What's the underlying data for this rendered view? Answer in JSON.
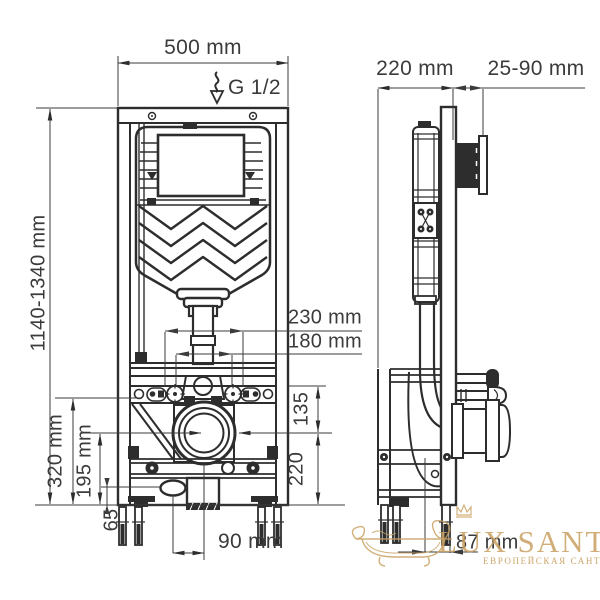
{
  "title": "Concealed WC installation frame — dimensional drawing",
  "views": {
    "front": {
      "width": "500 mm",
      "height": "1140-1340 mm",
      "water_supply": "G 1/2",
      "fixing_outer": "230 mm",
      "fixing_inner": "180 mm",
      "stud_to_outlet": "135",
      "outlet_to_floor": "220",
      "bracket_height": "320 mm",
      "outlet_height": "195 mm",
      "inlet_height": "65",
      "inlet_offset": "90 mm"
    },
    "side": {
      "depth": "220 mm",
      "wall_distance": "25-90 mm",
      "outlet_offset": "87 mm"
    }
  },
  "watermark": {
    "brand": "LUX SANTEH",
    "tagline": "ЕВРОПЕЙСКАЯ САНТЕХНИКА",
    "color": "#c9a262"
  },
  "colors": {
    "line": "#2d2d2d",
    "dim_text": "#3b3b3b",
    "background": "#ffffff"
  }
}
